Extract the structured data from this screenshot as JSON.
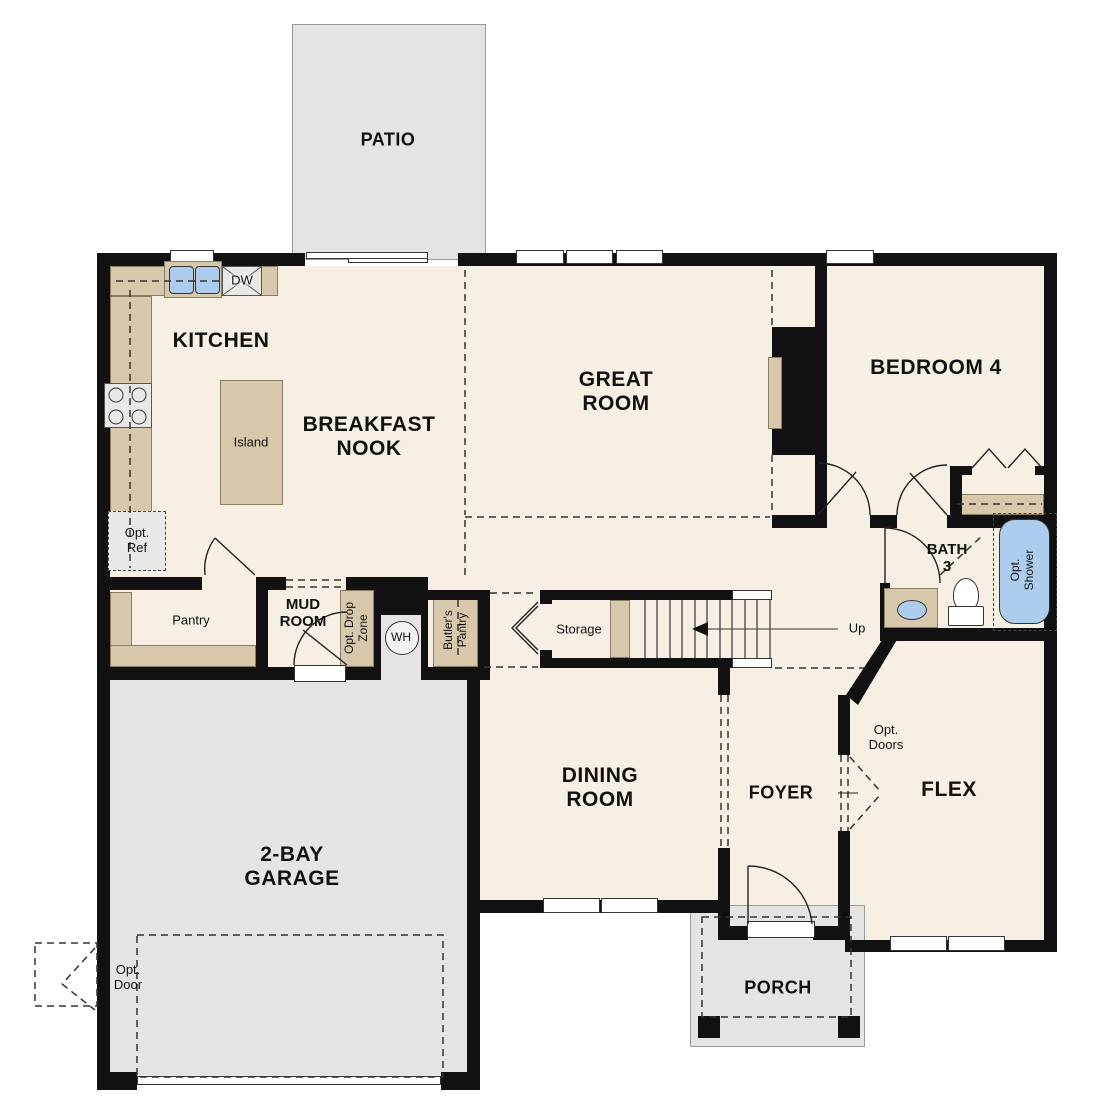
{
  "colors": {
    "wall": "#111111",
    "floor": "#f7efe3",
    "hard_surface": "#e4e4e2",
    "counter": "#d8c8ab",
    "fixture_blue": "#abccec",
    "appliance": "#e8e8e6",
    "line": "#333333"
  },
  "rooms": {
    "patio": "PATIO",
    "kitchen": "KITCHEN",
    "breakfast_nook": "BREAKFAST\nNOOK",
    "great_room": "GREAT\nROOM",
    "bedroom4": "BEDROOM 4",
    "bath3": "BATH\n3",
    "mud_room": "MUD\nROOM",
    "pantry": "Pantry",
    "storage": "Storage",
    "dining_room": "DINING\nROOM",
    "foyer": "FOYER",
    "flex": "FLEX",
    "garage": "2-BAY\nGARAGE",
    "porch": "PORCH"
  },
  "features": {
    "island": "Island",
    "dw": "DW",
    "opt_ref": "Opt.\nRef",
    "opt_drop_zone": "Opt. Drop\nZone",
    "wh": "WH",
    "butlers_pantry": "Butler's\nPantry",
    "up": "Up",
    "opt_shower": "Opt.\nShower",
    "opt_doors": "Opt.\nDoors",
    "opt_door": "Opt.\nDoor"
  }
}
